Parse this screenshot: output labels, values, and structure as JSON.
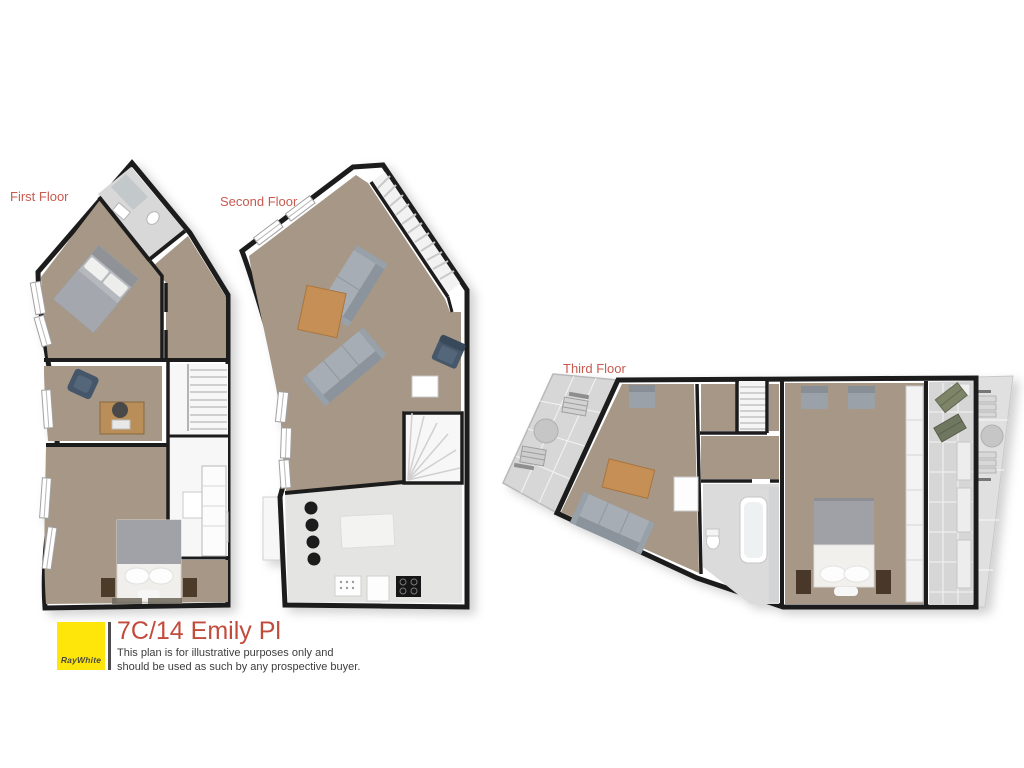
{
  "floors": [
    {
      "id": "first-floor",
      "label": "First Floor"
    },
    {
      "id": "second-floor",
      "label": "Second Floor"
    },
    {
      "id": "third-floor",
      "label": "Third Floor"
    }
  ],
  "branding": {
    "agency_name": "RayWhite",
    "property_title": "7C/14 Emily Pl",
    "disclaimer_line1": "This plan is for illustrative purposes only and",
    "disclaimer_line2": "should be used as such by any prospective buyer."
  },
  "colors": {
    "floor_label_red": "#c85a50",
    "title_red": "#c34b3c",
    "logo_yellow": "#ffe60a",
    "separator_gray": "#4d4d4d",
    "disclaimer_gray": "#3d3d3d",
    "wall_black": "#1f1f1f",
    "room_tan": "#a69786",
    "wet_area_gray": "#dbdbdb",
    "kitchen_gray": "#e4e4e3",
    "terrace_gray": "#d6d6d6"
  }
}
